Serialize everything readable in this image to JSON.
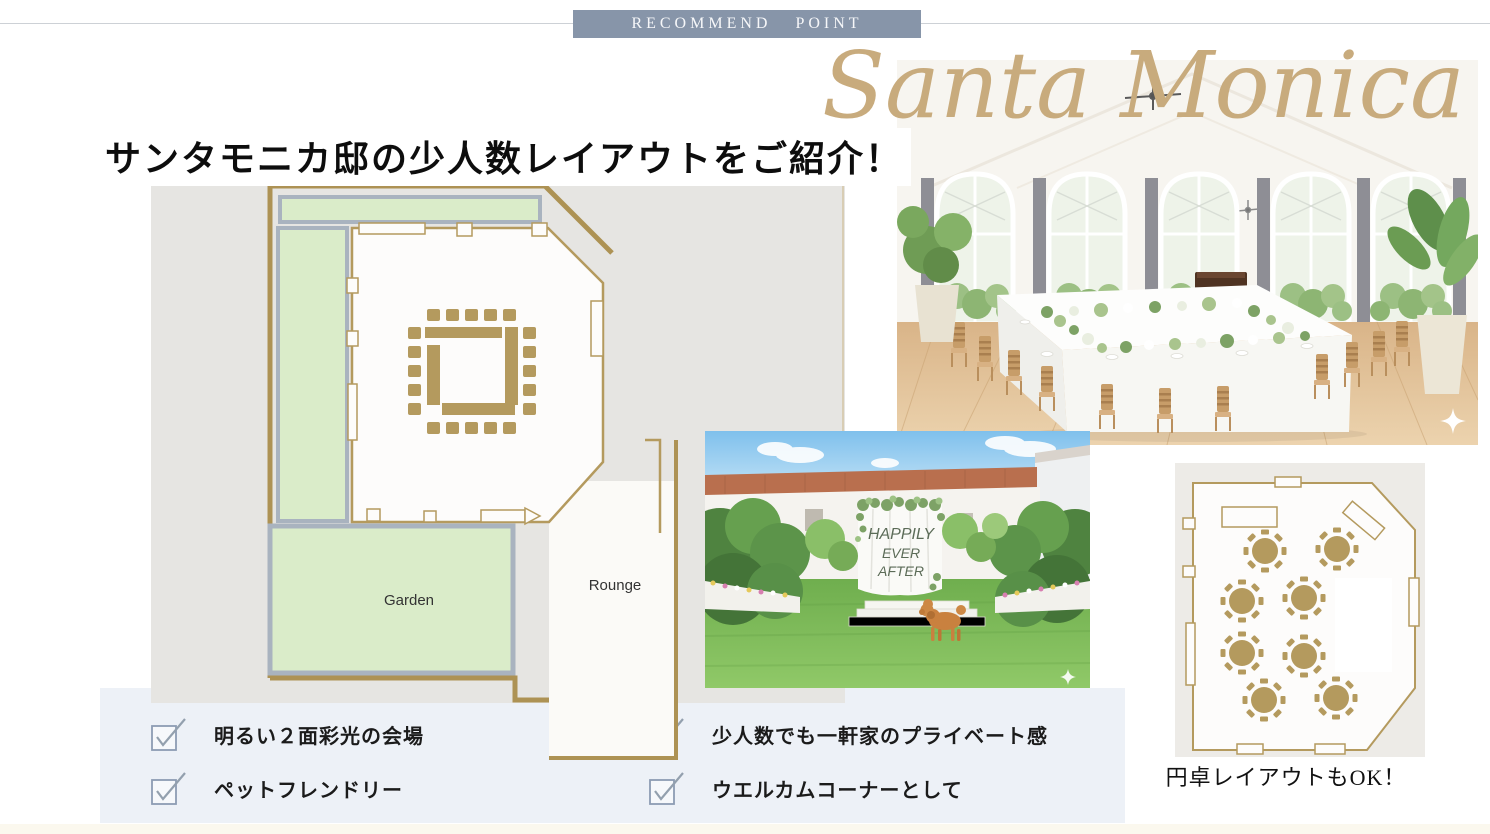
{
  "banner": {
    "label": "RECOMMEND POINT"
  },
  "script_title": "Santa Monica",
  "heading": "サンタモニカ邸の少人数レイアウトをご紹介！",
  "main_floor_plan": {
    "garden_label": "Garden",
    "lounge_label": "Rounge"
  },
  "round_table_plan": {
    "caption": "円卓レイアウトもOK！"
  },
  "garden_photo": {
    "backdrop_lines": [
      "HAPPILY",
      "EVER",
      "AFTER"
    ]
  },
  "checklist": {
    "items": [
      {
        "label": "明るい２面彩光の会場"
      },
      {
        "label": "ペットフレンドリー"
      },
      {
        "label": "少人数でも一軒家のプライベート感"
      },
      {
        "label": "ウエルカムコーナーとして"
      }
    ]
  },
  "colors": {
    "accent_gold": "#b49a5e",
    "banner_blue": "#8795a9",
    "plan_green": "#daecc9",
    "panel_blue": "#edf1f7"
  }
}
